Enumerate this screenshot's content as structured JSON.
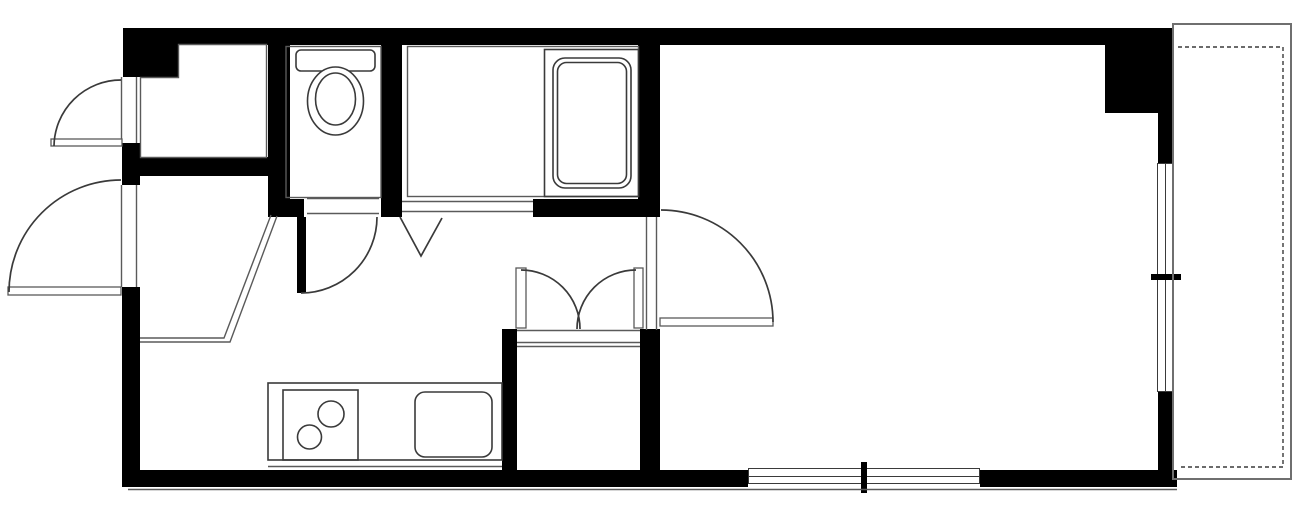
{
  "canvas": {
    "width": 1300,
    "height": 514
  },
  "colors": {
    "background": "#ffffff",
    "wall": "#000000",
    "line": "#3a3a3a",
    "thin_line": "#5a5a5a",
    "frame_line": "#6f6f6f"
  },
  "legend": {
    "drawing_type": "apartment-floor-plan",
    "fixtures": [
      "toilet-with-tank",
      "bathtub",
      "kitchen-counter",
      "two-burner-stove",
      "kitchen-sink",
      "closet-double-doors"
    ],
    "features": [
      "entrance-swing-doors",
      "interior-swing-doors",
      "folding-bath-door",
      "sliding-window-right",
      "sliding-window-bottom",
      "balcony-dashed-outline",
      "entrance-step-edge"
    ]
  }
}
